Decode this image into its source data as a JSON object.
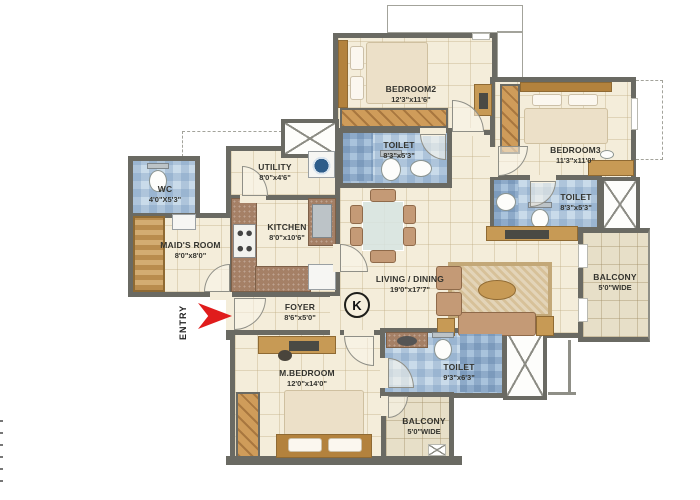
{
  "plan": {
    "title": "apartment-floor-plan",
    "rooms": {
      "bedroom2": {
        "name": "BEDROOM2",
        "dims": "12'3\"x11'6\""
      },
      "bedroom3": {
        "name": "BEDROOM3",
        "dims": "11'3\"x11'0\""
      },
      "toilet2": {
        "name": "TOILET",
        "dims": "8'3\"x5'3\""
      },
      "toilet3": {
        "name": "TOILET",
        "dims": "8'3\"x5'3\""
      },
      "utility": {
        "name": "UTILITY",
        "dims": "8'0\"x4'6\""
      },
      "kitchen": {
        "name": "KITCHEN",
        "dims": "8'0\"x10'6\""
      },
      "wc": {
        "name": "WC",
        "dims": "4'0\"X5'3\""
      },
      "maids_room": {
        "name": "MAID'S ROOM",
        "dims": "8'0\"x8'0\""
      },
      "living_dining": {
        "name": "LIVING / DINING",
        "dims": "19'0\"x17'7\""
      },
      "foyer": {
        "name": "FOYER",
        "dims": "8'6\"x5'0\""
      },
      "master_bedroom": {
        "name": "M.BEDROOM",
        "dims": "12'0\"x14'0\""
      },
      "toilet_master": {
        "name": "TOILET",
        "dims": "9'3\"x6'3\""
      },
      "balcony_right": {
        "name": "BALCONY",
        "dims": "5'0\"WIDE"
      },
      "balcony_bottom": {
        "name": "BALCONY",
        "dims": "5'0\"WIDE"
      }
    },
    "entry_label": "ENTRY",
    "compass_letter": "K",
    "colors": {
      "wall": "#6a6a63",
      "floor_tile": "#f4edda",
      "wet_tile": "#c9dbea",
      "balcony_tile": "#e7dfc8",
      "wood": "#c79a55",
      "counter": "#a58066",
      "entry_arrow": "#e01c1c",
      "rug": "#d7c199"
    }
  }
}
